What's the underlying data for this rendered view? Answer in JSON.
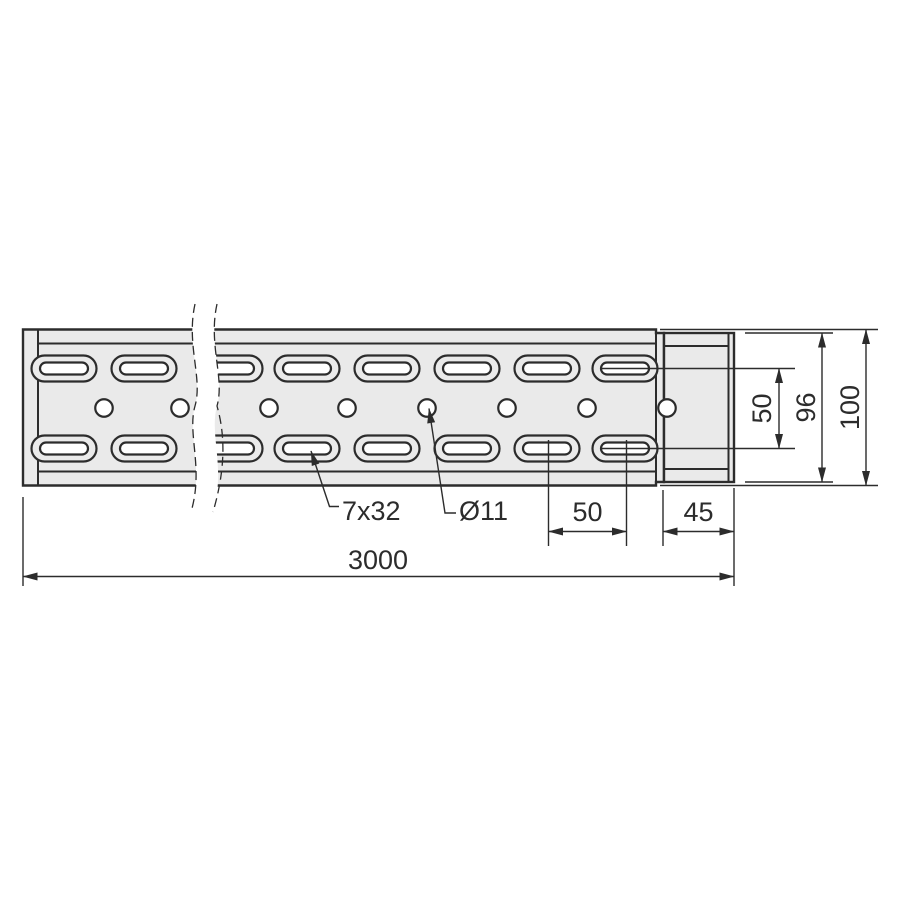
{
  "drawing": {
    "labels": {
      "overall_length": "3000",
      "height_total": "100",
      "height_connector": "96",
      "slot_row_spacing": "50",
      "slot_pitch": "50",
      "connector_length": "45",
      "slot_dimensions": "7x32",
      "hole_diameter": "Ø11"
    },
    "colors": {
      "line": "#2c2c2c",
      "body_fill": "#eaeaea",
      "cutout_fill": "#ffffff",
      "background": "#ffffff"
    }
  }
}
